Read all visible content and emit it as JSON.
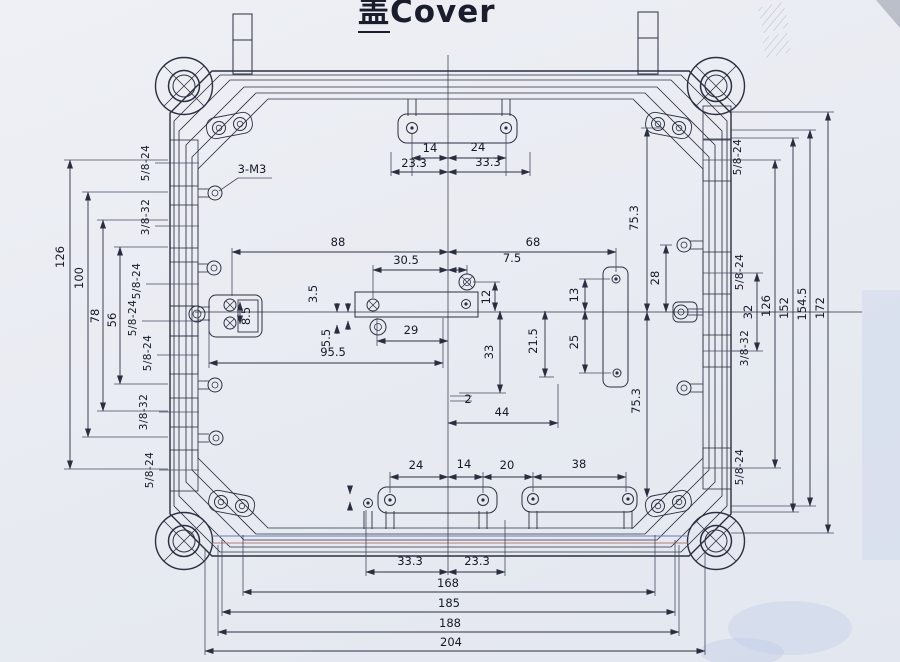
{
  "title": {
    "cn": "盖",
    "en": "Cover"
  },
  "labels": {
    "t14": "14",
    "t24": "24",
    "t233": "23.3",
    "t333": "33.3",
    "c88": "88",
    "c68": "68",
    "c305": "30.5",
    "c75": "7.5",
    "c12": "12",
    "c29": "29",
    "c35": "3.5",
    "c55": "5.5",
    "c85": "8.5",
    "c955": "95.5",
    "c33": "33",
    "c215": "21.5",
    "c13": "13",
    "c25": "25",
    "c28": "28",
    "c2a": "2",
    "c44": "44",
    "r753t": "75.3",
    "r753b": "75.3",
    "L126": "126",
    "L100": "100",
    "L78": "78",
    "L56": "56",
    "R32": "32",
    "R126": "126",
    "R152": "152",
    "R1545": "154.5",
    "R172": "172",
    "b24": "24",
    "b14": "14",
    "b20": "20",
    "b38": "38",
    "b2": "2",
    "bb333": "33.3",
    "bb233": "23.3",
    "bb168": "168",
    "bb185": "185",
    "bb188": "188",
    "bb204": "204",
    "m3": "3-M3",
    "lt1": "5/8-24",
    "lt2": "3/8-32",
    "lt3": "5/8-24",
    "lt4": "5/8-24",
    "lt5": "5/8-24",
    "lt6": "3/8-32",
    "lt7": "5/8-24",
    "rt1": "5/8-24",
    "rt2": "5/8-24",
    "rt3": "3/8-32",
    "rt4": "5/8-24"
  }
}
